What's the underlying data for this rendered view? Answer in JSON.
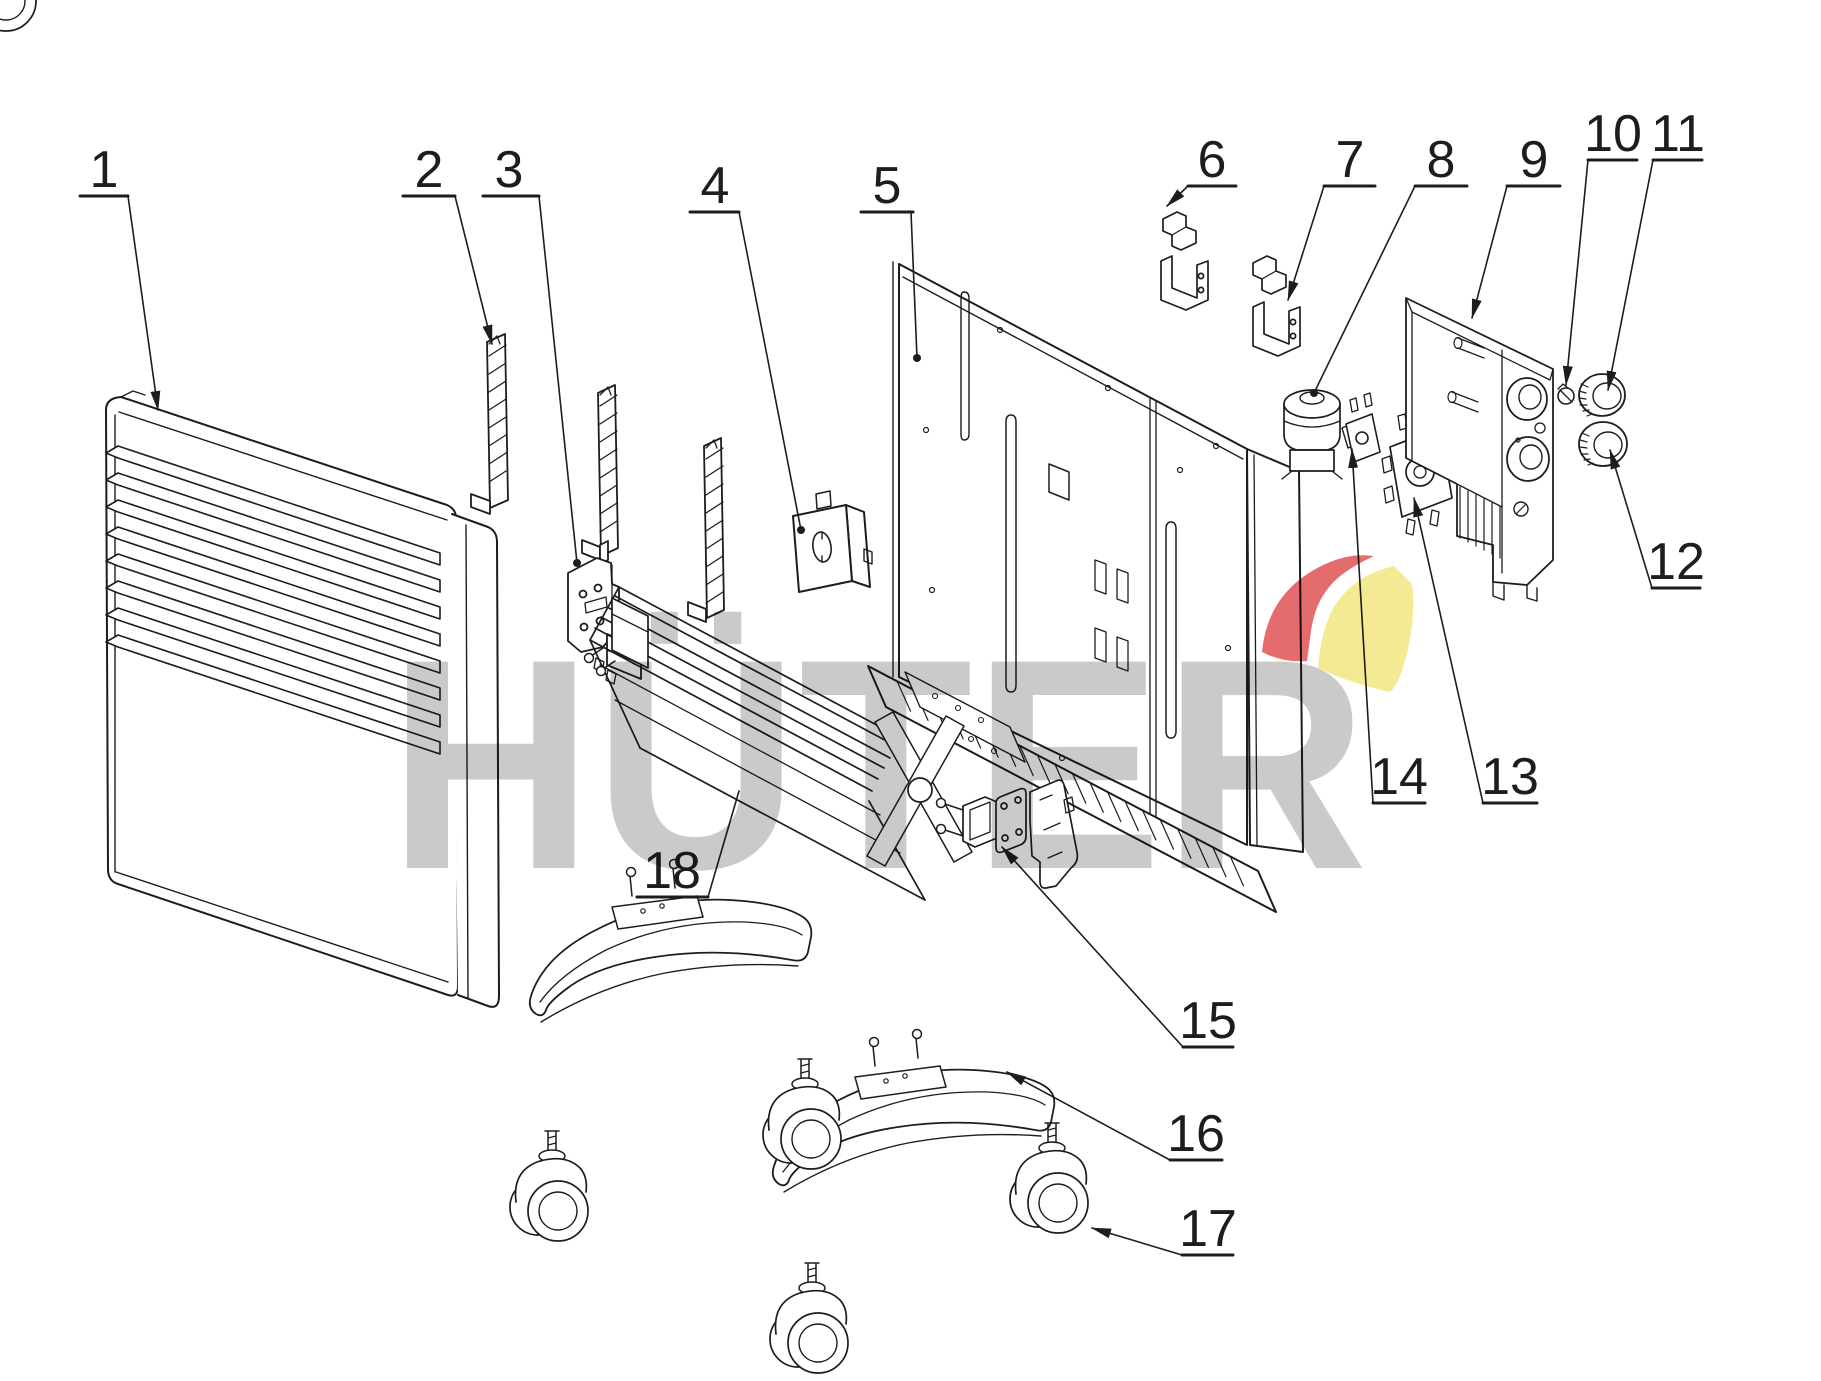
{
  "watermark": {
    "text": "HÜTER",
    "letter_color": "#c6c6c6",
    "logo_red": "#e25f5f",
    "logo_yellow": "#f2e98a"
  },
  "figure": {
    "width": 1821,
    "height": 1381,
    "stroke": "#1d1d1d",
    "background": "#ffffff"
  },
  "parts": [
    {
      "n": "1",
      "label": {
        "x": 104,
        "y": 187
      },
      "underline": {
        "x1": 80,
        "x2": 128,
        "y": 196
      },
      "leader": {
        "x1": 128,
        "y1": 196,
        "x2": 158,
        "y2": 410,
        "end": "arrow"
      }
    },
    {
      "n": "2",
      "label": {
        "x": 429,
        "y": 187
      },
      "underline": {
        "x1": 403,
        "x2": 455,
        "y": 196
      },
      "leader": {
        "x1": 455,
        "y1": 196,
        "x2": 492,
        "y2": 344,
        "end": "arrow"
      }
    },
    {
      "n": "3",
      "label": {
        "x": 509,
        "y": 187
      },
      "underline": {
        "x1": 483,
        "x2": 539,
        "y": 196
      },
      "leader": {
        "x1": 539,
        "y1": 196,
        "x2": 577,
        "y2": 563,
        "end": "dot"
      }
    },
    {
      "n": "4",
      "label": {
        "x": 715,
        "y": 203
      },
      "underline": {
        "x1": 690,
        "x2": 739,
        "y": 212
      },
      "leader": {
        "x1": 739,
        "y1": 212,
        "x2": 801,
        "y2": 530,
        "end": "dot"
      }
    },
    {
      "n": "5",
      "label": {
        "x": 887,
        "y": 203
      },
      "underline": {
        "x1": 861,
        "x2": 913,
        "y": 212
      },
      "leader": {
        "x1": 911,
        "y1": 212,
        "x2": 917,
        "y2": 358,
        "end": "dot"
      }
    },
    {
      "n": "6",
      "label": {
        "x": 1212,
        "y": 177
      },
      "underline": {
        "x1": 1188,
        "x2": 1236,
        "y": 186
      },
      "leader": {
        "x1": 1188,
        "y1": 186,
        "x2": 1167,
        "y2": 206,
        "end": "arrow"
      }
    },
    {
      "n": "7",
      "label": {
        "x": 1350,
        "y": 177
      },
      "underline": {
        "x1": 1324,
        "x2": 1375,
        "y": 186
      },
      "leader": {
        "x1": 1324,
        "y1": 186,
        "x2": 1288,
        "y2": 300,
        "end": "arrow"
      }
    },
    {
      "n": "8",
      "label": {
        "x": 1441,
        "y": 177
      },
      "underline": {
        "x1": 1415,
        "x2": 1467,
        "y": 186
      },
      "leader": {
        "x1": 1415,
        "y1": 186,
        "x2": 1314,
        "y2": 393,
        "end": "dot"
      }
    },
    {
      "n": "9",
      "label": {
        "x": 1534,
        "y": 177
      },
      "underline": {
        "x1": 1507,
        "x2": 1560,
        "y": 186
      },
      "leader": {
        "x1": 1507,
        "y1": 186,
        "x2": 1472,
        "y2": 318,
        "end": "arrow"
      }
    },
    {
      "n": "10",
      "label": {
        "x": 1613,
        "y": 151
      },
      "underline": {
        "x1": 1588,
        "x2": 1637,
        "y": 160
      },
      "leader": {
        "x1": 1588,
        "y1": 160,
        "x2": 1566,
        "y2": 385,
        "end": "arrow"
      }
    },
    {
      "n": "11",
      "label": {
        "x": 1678,
        "y": 151
      },
      "underline": {
        "x1": 1653,
        "x2": 1702,
        "y": 160
      },
      "leader": {
        "x1": 1653,
        "y1": 160,
        "x2": 1608,
        "y2": 390,
        "end": "arrow"
      }
    },
    {
      "n": "12",
      "label": {
        "x": 1676,
        "y": 579
      },
      "underline": {
        "x1": 1652,
        "x2": 1700,
        "y": 588
      },
      "leader": {
        "x1": 1652,
        "y1": 588,
        "x2": 1610,
        "y2": 450,
        "end": "arrow"
      }
    },
    {
      "n": "13",
      "label": {
        "x": 1510,
        "y": 794
      },
      "underline": {
        "x1": 1483,
        "x2": 1537,
        "y": 803
      },
      "leader": {
        "x1": 1483,
        "y1": 803,
        "x2": 1414,
        "y2": 498,
        "end": "arrow"
      }
    },
    {
      "n": "14",
      "label": {
        "x": 1399,
        "y": 794
      },
      "underline": {
        "x1": 1373,
        "x2": 1425,
        "y": 803
      },
      "leader": {
        "x1": 1373,
        "y1": 803,
        "x2": 1352,
        "y2": 449,
        "end": "arrow"
      }
    },
    {
      "n": "15",
      "label": {
        "x": 1208,
        "y": 1038
      },
      "underline": {
        "x1": 1183,
        "x2": 1233,
        "y": 1047
      },
      "leader": {
        "x1": 1183,
        "y1": 1047,
        "x2": 1002,
        "y2": 847,
        "end": "arrow"
      }
    },
    {
      "n": "16",
      "label": {
        "x": 1196,
        "y": 1151
      },
      "underline": {
        "x1": 1170,
        "x2": 1222,
        "y": 1160
      },
      "leader": {
        "x1": 1170,
        "y1": 1160,
        "x2": 1007,
        "y2": 1072,
        "end": "arrow"
      }
    },
    {
      "n": "17",
      "label": {
        "x": 1208,
        "y": 1246
      },
      "underline": {
        "x1": 1182,
        "x2": 1233,
        "y": 1255
      },
      "leader": {
        "x1": 1182,
        "y1": 1255,
        "x2": 1092,
        "y2": 1228,
        "end": "arrow"
      }
    },
    {
      "n": "18",
      "label": {
        "x": 672,
        "y": 888
      },
      "underline": {
        "x1": 637,
        "x2": 708,
        "y": 897
      },
      "leader": {
        "x1": 708,
        "y1": 897,
        "x2": 739,
        "y2": 791,
        "end": "none"
      }
    }
  ],
  "repeats": {
    "louvers": {
      "x": 118,
      "y0": 446,
      "step": 27,
      "count": 8,
      "dx": 322,
      "dy": 107,
      "t": 12,
      "tip": 12
    },
    "grille": {
      "x1": 880,
      "y1": 673,
      "x2": 1248,
      "y2": 866,
      "count": 21,
      "tx": 13,
      "ty": 29
    },
    "hatch_strips": [
      {
        "x1": 489,
        "y1": 356,
        "x2": 506,
        "y2": 345,
        "count": 8,
        "sy": 18
      },
      {
        "x1": 600,
        "y1": 406,
        "x2": 617,
        "y2": 395,
        "count": 8,
        "sy": 18
      },
      {
        "x1": 706,
        "y1": 459,
        "x2": 723,
        "y2": 448,
        "count": 9,
        "sy": 18
      }
    ]
  }
}
